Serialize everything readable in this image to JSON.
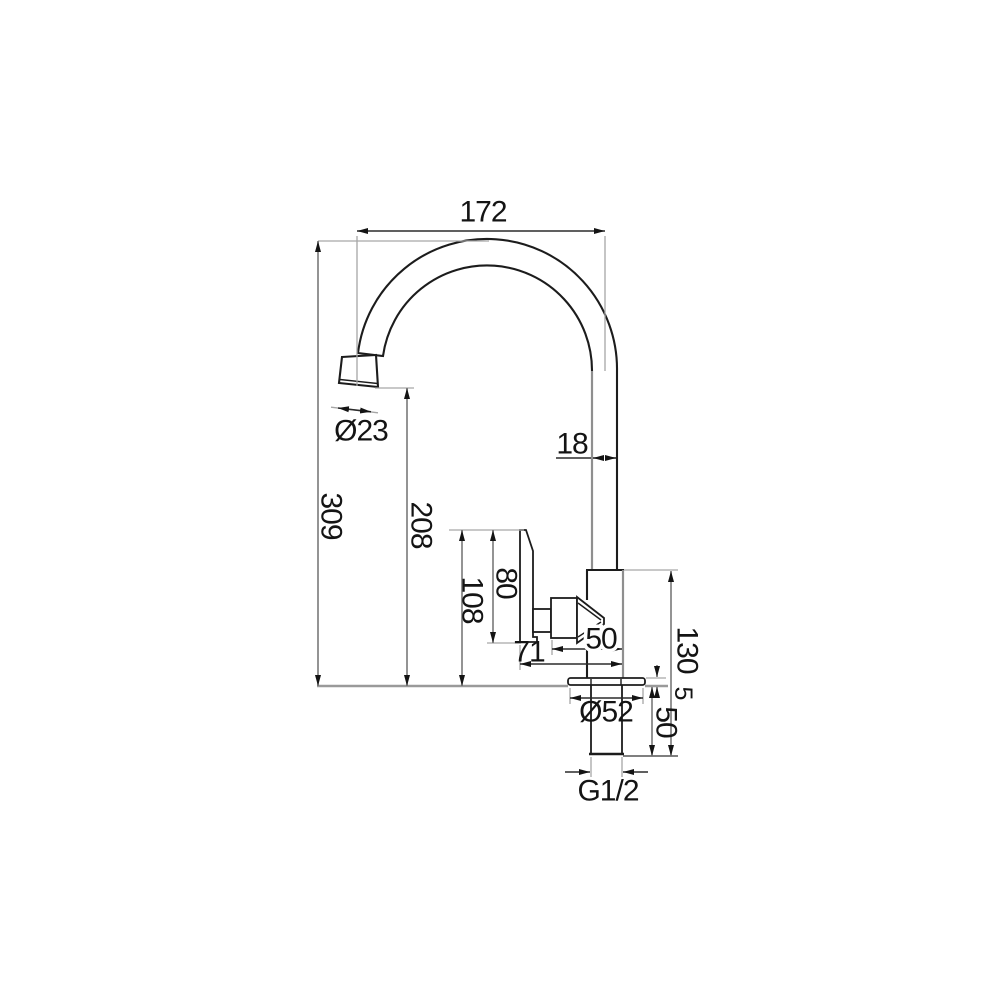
{
  "dims": {
    "spout_reach": "172",
    "spout_tube": "18",
    "height_overall": "309",
    "height_outlet": "208",
    "lever_top": "80",
    "lever_overall": "108",
    "lever_reach": "71",
    "valve_reach": "50",
    "body_height": "130",
    "flange_thickness": "5",
    "shank_length": "50",
    "base_diameter": "Ø52",
    "aerator_diameter": "Ø23",
    "inlet_thread": "G1/2"
  },
  "colors": {
    "outline": "#1c1c1c",
    "dimension_line": "#777777",
    "extension_line": "#a6a6a6",
    "arrowhead": "#141414",
    "text": "#141414",
    "background": "#ffffff"
  }
}
